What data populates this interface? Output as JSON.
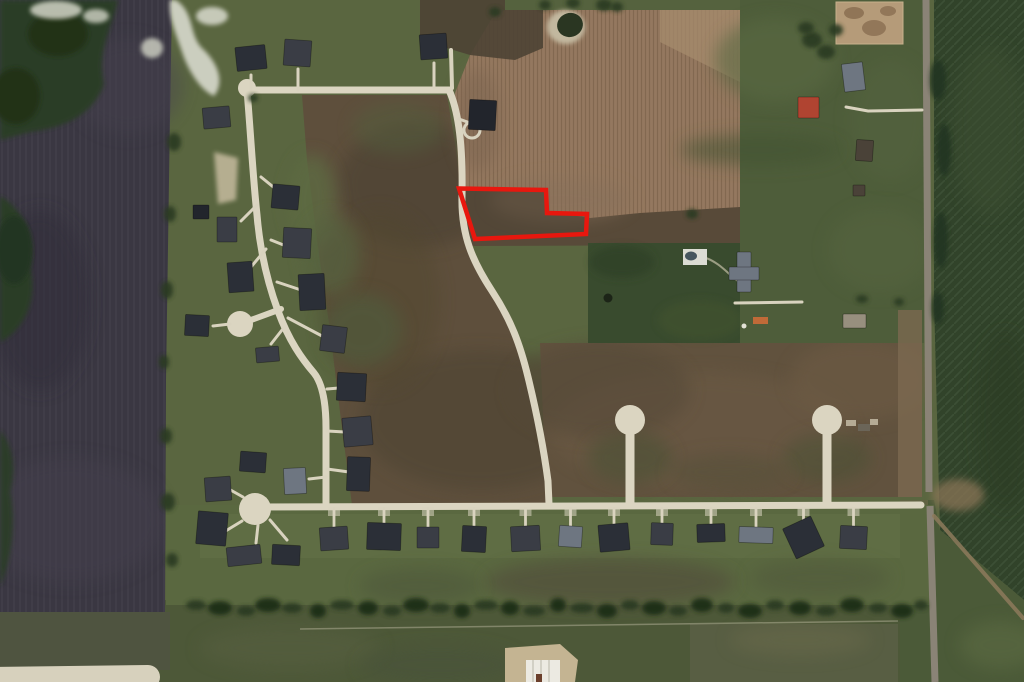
{
  "meta": {
    "type": "aerial-satellite-photo",
    "scene": "Rural residential subdivision with farmland; vacant lot outlined in red",
    "width": 1024,
    "height": 682
  },
  "highlight": {
    "label": "property-boundary",
    "color": "#e8170e",
    "stroke_width": 4.5,
    "points": "459,188.5 546,190 547,213 587,214 586,234 475,239"
  },
  "palette": {
    "base_green": "#5a6640",
    "dark_plowed_field": "#3a3742",
    "brown_field": "#5e4f3c",
    "tan_crop_field": "#94785f",
    "dark_green_block": "#394b2e",
    "pasture": "#4e5d3a",
    "right_crop_field": "#31432a",
    "road_cream": "#dbd5c1",
    "road_gray": "#8a8376",
    "house": [
      "#2b2f37",
      "#3a3d45",
      "#6e7681",
      "#4a4238",
      "#22252c"
    ]
  },
  "roads": {
    "top": "M 247,90 L 449,90",
    "curve": "M 449,90 C 459,112 463,148 462,196 C 461,236 473,262 492,291 C 511,320 520,344 528,377 C 537,414 544,451 548,481 L 549,504",
    "west": "M 247,90 C 251,138 253,178 257,215 C 260,251 267,281 278,311 C 289,341 302,359 314,373 C 322,383 326,401 326,428 L 326,503",
    "bottom": "M 256,507 L 921,505",
    "connector": "M 251,320 L 281,309",
    "stem1": "M 630,434 L 630,503",
    "stem2": "M 827,434 L 827,503",
    "country_north": "M 926,0 L 929,492",
    "country_south": "M 930,506 L 935,682",
    "dirt_track": "M 934,516 L 1023,618",
    "farm_drive": "M 922,110 L 868,111 L 846,107",
    "farmhouse_drive": "M 735,303 L 802,302",
    "pool_path": "M 706,258 C 720,263 729,275 738,281",
    "house3_lane": "M 451,50 L 452,88",
    "house4_drive": "M 459,119 L 473,124",
    "bottom_left_road": "M -14,679 L 148,677"
  },
  "cul_de_sacs": [
    {
      "cx": 247,
      "cy": 88,
      "r": 9
    },
    {
      "cx": 240,
      "cy": 324,
      "r": 13
    },
    {
      "cx": 255,
      "cy": 509,
      "r": 16
    },
    {
      "cx": 630,
      "cy": 420,
      "r": 15
    },
    {
      "cx": 827,
      "cy": 420,
      "r": 15
    }
  ],
  "driveways": [
    [
      251,
      75,
      251,
      90
    ],
    [
      298,
      69,
      298,
      90
    ],
    [
      434,
      63,
      434,
      88
    ],
    [
      261,
      177,
      277,
      190
    ],
    [
      257,
      205,
      241,
      221
    ],
    [
      266,
      249,
      251,
      267
    ],
    [
      271,
      240,
      286,
      246
    ],
    [
      277,
      282,
      301,
      290
    ],
    [
      288,
      318,
      322,
      336
    ],
    [
      230,
      324,
      213,
      326
    ],
    [
      282,
      330,
      271,
      344
    ],
    [
      327,
      389,
      339,
      388
    ],
    [
      327,
      431,
      345,
      432
    ],
    [
      327,
      469,
      349,
      472
    ],
    [
      326,
      477,
      309,
      479
    ],
    [
      243,
      497,
      227,
      488
    ],
    [
      242,
      521,
      219,
      535
    ],
    [
      258,
      525,
      256,
      543
    ],
    [
      270,
      520,
      287,
      540
    ]
  ],
  "houses": [
    [
      236,
      46,
      30,
      24,
      -6,
      0,
      0
    ],
    [
      284,
      40,
      27,
      26,
      4,
      1,
      0
    ],
    [
      420,
      34,
      27,
      25,
      -4,
      0,
      0
    ],
    [
      469,
      100,
      27,
      30,
      3,
      4,
      0
    ],
    [
      203,
      107,
      27,
      21,
      -5,
      1,
      0
    ],
    [
      272,
      185,
      27,
      24,
      5,
      0,
      0
    ],
    [
      217,
      217,
      20,
      25,
      0,
      1,
      0
    ],
    [
      193,
      205,
      16,
      14,
      0,
      4,
      0
    ],
    [
      228,
      262,
      25,
      30,
      -4,
      0,
      0
    ],
    [
      283,
      228,
      28,
      30,
      3,
      1,
      0
    ],
    [
      299,
      274,
      26,
      36,
      -3,
      0,
      0
    ],
    [
      321,
      326,
      25,
      26,
      7,
      1,
      0
    ],
    [
      185,
      315,
      24,
      21,
      3,
      0,
      0
    ],
    [
      256,
      347,
      23,
      15,
      -5,
      1,
      0
    ],
    [
      337,
      373,
      29,
      28,
      3,
      0,
      0
    ],
    [
      343,
      417,
      29,
      29,
      -5,
      1,
      0
    ],
    [
      347,
      457,
      23,
      34,
      2,
      0,
      0
    ],
    [
      284,
      468,
      22,
      26,
      -3,
      2,
      0
    ],
    [
      240,
      452,
      26,
      20,
      4,
      0,
      0
    ],
    [
      205,
      477,
      26,
      24,
      -4,
      1,
      0
    ],
    [
      197,
      512,
      30,
      33,
      5,
      0,
      0
    ],
    [
      227,
      546,
      34,
      19,
      -6,
      1,
      0
    ],
    [
      272,
      545,
      28,
      20,
      3,
      0,
      0
    ],
    [
      320,
      527,
      28,
      23,
      -4,
      1,
      1
    ],
    [
      367,
      523,
      34,
      27,
      2,
      0,
      1
    ],
    [
      417,
      527,
      22,
      21,
      0,
      1,
      1
    ],
    [
      462,
      526,
      24,
      26,
      3,
      0,
      1
    ],
    [
      511,
      526,
      29,
      25,
      -3,
      1,
      1
    ],
    [
      559,
      526,
      23,
      21,
      4,
      2,
      1
    ],
    [
      599,
      524,
      30,
      27,
      -5,
      0,
      1
    ],
    [
      651,
      523,
      22,
      22,
      2,
      1,
      1
    ],
    [
      697,
      524,
      28,
      18,
      -2,
      0,
      1
    ],
    [
      739,
      527,
      34,
      16,
      2,
      2,
      1
    ],
    [
      788,
      521,
      31,
      33,
      -25,
      0,
      1
    ],
    [
      840,
      526,
      27,
      23,
      3,
      1,
      1
    ],
    [
      798,
      97,
      21,
      21,
      0,
      "#b04431",
      0
    ],
    [
      843,
      63,
      21,
      28,
      -7,
      2,
      0
    ],
    [
      856,
      140,
      17,
      21,
      4,
      3,
      0
    ],
    [
      853,
      185,
      12,
      11,
      0,
      3,
      0
    ],
    [
      843,
      314,
      23,
      14,
      0,
      "#978f7e",
      0
    ],
    [
      737,
      252,
      14,
      40,
      0,
      2,
      0
    ],
    [
      729,
      267,
      30,
      13,
      0,
      2,
      0
    ]
  ],
  "trees_scattered": [
    [
      174,
      142,
      7,
      9
    ],
    [
      170,
      214,
      6,
      8
    ],
    [
      167,
      290,
      6,
      9
    ],
    [
      164,
      362,
      5,
      7
    ],
    [
      166,
      436,
      6,
      8
    ],
    [
      168,
      502,
      7,
      9
    ],
    [
      172,
      560,
      6,
      7
    ],
    [
      545,
      5,
      6,
      5
    ],
    [
      573,
      3,
      7,
      5
    ],
    [
      604,
      5,
      8,
      6
    ],
    [
      617,
      7,
      6,
      5
    ],
    [
      692,
      214,
      6,
      5
    ],
    [
      862,
      299,
      6,
      4
    ],
    [
      899,
      302,
      5,
      4
    ],
    [
      812,
      40,
      10,
      8
    ],
    [
      826,
      52,
      9,
      7
    ],
    [
      806,
      28,
      8,
      6
    ],
    [
      836,
      30,
      7,
      6
    ],
    [
      938,
      80,
      8,
      20
    ],
    [
      944,
      150,
      7,
      26
    ],
    [
      941,
      240,
      7,
      28
    ],
    [
      938,
      308,
      6,
      16
    ],
    [
      253,
      98,
      5,
      4
    ],
    [
      495,
      12,
      6,
      5
    ]
  ],
  "tree_line_south": {
    "y": 608,
    "items": [
      [
        196,
        10
      ],
      [
        220,
        12
      ],
      [
        246,
        9
      ],
      [
        268,
        13
      ],
      [
        292,
        10
      ],
      [
        318,
        8
      ],
      [
        342,
        12
      ],
      [
        368,
        10
      ],
      [
        392,
        9
      ],
      [
        416,
        13
      ],
      [
        440,
        10
      ],
      [
        462,
        8
      ],
      [
        486,
        12
      ],
      [
        510,
        9
      ],
      [
        534,
        11
      ],
      [
        558,
        8
      ],
      [
        582,
        12
      ],
      [
        607,
        10
      ],
      [
        630,
        9
      ],
      [
        654,
        12
      ],
      [
        678,
        9
      ],
      [
        702,
        11
      ],
      [
        726,
        8
      ],
      [
        750,
        12
      ],
      [
        775,
        9
      ],
      [
        800,
        11
      ],
      [
        826,
        10
      ],
      [
        852,
        12
      ],
      [
        878,
        9
      ],
      [
        902,
        11
      ],
      [
        921,
        7
      ]
    ]
  },
  "equipment_patches": [
    [
      846,
      420,
      10,
      6
    ],
    [
      858,
      424,
      12,
      7
    ],
    [
      870,
      419,
      8,
      6
    ]
  ]
}
